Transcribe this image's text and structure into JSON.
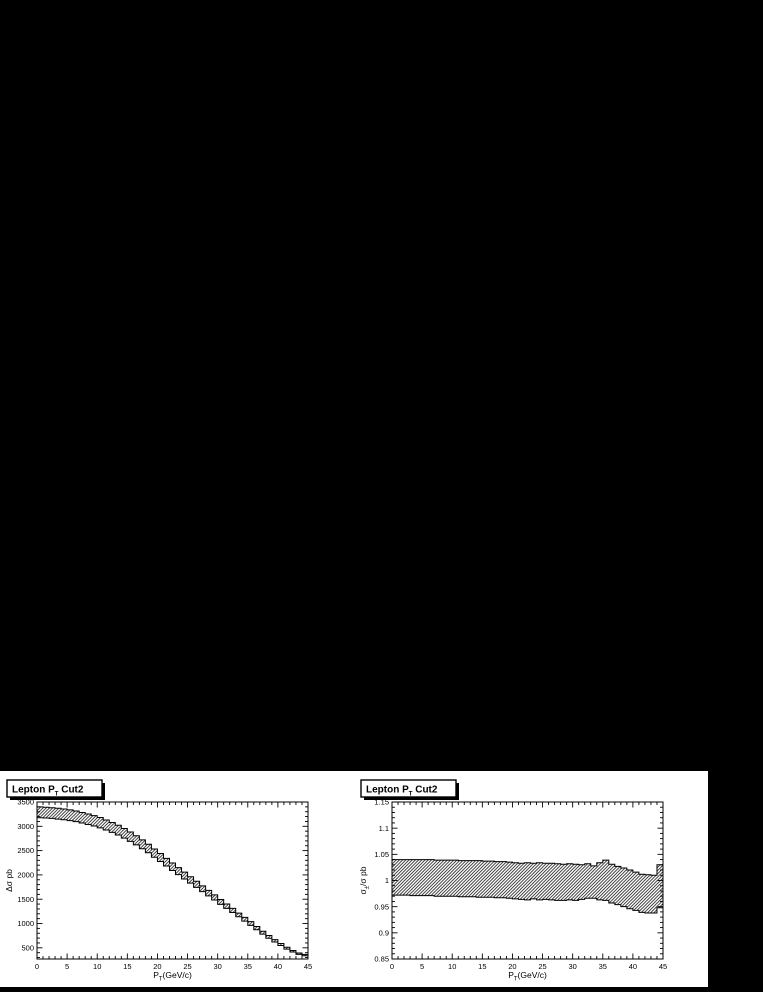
{
  "page": {
    "background_color": "#000000",
    "canvas_color": "#ffffff",
    "ink_color": "#000000"
  },
  "chart_data": [
    {
      "type": "area",
      "style": "hatched-uncertainty-band-histogram",
      "title": "Lepton P_T Cut2",
      "title_parts": {
        "pre": "Lepton P",
        "sub": "T",
        "post": " Cut2"
      },
      "xlabel": "P_T(GeV/c)",
      "xlabel_parts": {
        "pre": "P",
        "sub": "T",
        "post": "(GeV/c)"
      },
      "ylabel": "Δσ pb",
      "ylabel_parts": {
        "pre": "Δσ pb",
        "sub": "",
        "post": ""
      },
      "xlim": [
        0,
        45
      ],
      "ylim": [
        270,
        3500
      ],
      "x_major_step": 5,
      "x_minor_step": 1,
      "x_tick_labels": [
        "0",
        "5",
        "10",
        "15",
        "20",
        "25",
        "30",
        "35",
        "40",
        "45"
      ],
      "y_major_ticks": [
        500,
        1000,
        1500,
        2000,
        2500,
        3000,
        3500
      ],
      "y_tick_labels": [
        "500",
        "1000",
        "1500",
        "2000",
        "2500",
        "3000",
        "3500"
      ],
      "y_minor_step": 100,
      "grid": false,
      "legend": null,
      "bin_width": 1,
      "bin_start": 0,
      "band_upper": [
        3399,
        3392,
        3383,
        3372,
        3357,
        3338,
        3316,
        3285,
        3254,
        3219,
        3180,
        3131,
        3079,
        3021,
        2956,
        2883,
        2806,
        2721,
        2631,
        2534,
        2440,
        2340,
        2246,
        2149,
        2057,
        1963,
        1870,
        1775,
        1681,
        1589,
        1494,
        1402,
        1311,
        1213,
        1127,
        1039,
        938,
        842,
        753,
        668,
        589,
        511,
        445,
        394,
        366
      ],
      "band_lower": [
        3176,
        3170,
        3162,
        3148,
        3134,
        3117,
        3096,
        3067,
        3038,
        3005,
        2968,
        2923,
        2874,
        2820,
        2757,
        2691,
        2619,
        2539,
        2456,
        2364,
        2277,
        2183,
        2092,
        2007,
        1916,
        1832,
        1743,
        1655,
        1568,
        1483,
        1395,
        1311,
        1226,
        1140,
        1050,
        962,
        871,
        782,
        698,
        620,
        547,
        474,
        413,
        366,
        336
      ],
      "colors": {
        "outline": "#000000",
        "hatch": "#1a1a1a",
        "fill": "none"
      }
    },
    {
      "type": "area",
      "style": "hatched-uncertainty-band-histogram",
      "title": "Lepton P_T Cut2",
      "title_parts": {
        "pre": "Lepton P",
        "sub": "T",
        "post": " Cut2"
      },
      "xlabel": "P_T(GeV/c)",
      "xlabel_parts": {
        "pre": "P",
        "sub": "T",
        "post": "(GeV/c)"
      },
      "ylabel": "σ_±/σ pb",
      "ylabel_parts": {
        "pre": "σ",
        "sub": "±",
        "post": "/σ pb"
      },
      "xlim": [
        0,
        45
      ],
      "ylim": [
        0.85,
        1.15
      ],
      "x_major_step": 5,
      "x_minor_step": 1,
      "x_tick_labels": [
        "0",
        "5",
        "10",
        "15",
        "20",
        "25",
        "30",
        "35",
        "40",
        "45"
      ],
      "y_major_ticks": [
        0.85,
        0.9,
        0.95,
        1,
        1.05,
        1.1,
        1.15
      ],
      "y_tick_labels": [
        "0.85",
        "0.9",
        "0.95",
        "1",
        "1.05",
        "1.1",
        "1.15"
      ],
      "y_minor_step": 0.01,
      "grid": false,
      "legend": null,
      "bin_width": 1,
      "bin_start": 0,
      "band_upper": [
        1.04,
        1.04,
        1.04,
        1.04,
        1.04,
        1.04,
        1.04,
        1.039,
        1.039,
        1.039,
        1.039,
        1.038,
        1.038,
        1.038,
        1.038,
        1.037,
        1.037,
        1.036,
        1.036,
        1.035,
        1.034,
        1.033,
        1.034,
        1.033,
        1.034,
        1.033,
        1.033,
        1.032,
        1.031,
        1.032,
        1.031,
        1.03,
        1.032,
        1.028,
        1.034,
        1.039,
        1.031,
        1.027,
        1.024,
        1.02,
        1.016,
        1.012,
        1.011,
        1.01,
        1.03
      ],
      "band_lower": [
        0.972,
        0.972,
        0.972,
        0.971,
        0.971,
        0.971,
        0.971,
        0.97,
        0.97,
        0.97,
        0.97,
        0.969,
        0.969,
        0.969,
        0.968,
        0.968,
        0.968,
        0.967,
        0.967,
        0.966,
        0.965,
        0.964,
        0.963,
        0.965,
        0.963,
        0.964,
        0.963,
        0.962,
        0.962,
        0.963,
        0.962,
        0.964,
        0.966,
        0.966,
        0.963,
        0.962,
        0.957,
        0.954,
        0.95,
        0.946,
        0.943,
        0.939,
        0.938,
        0.938,
        0.948
      ],
      "colors": {
        "outline": "#000000",
        "hatch": "#1a1a1a",
        "fill": "none"
      }
    }
  ]
}
